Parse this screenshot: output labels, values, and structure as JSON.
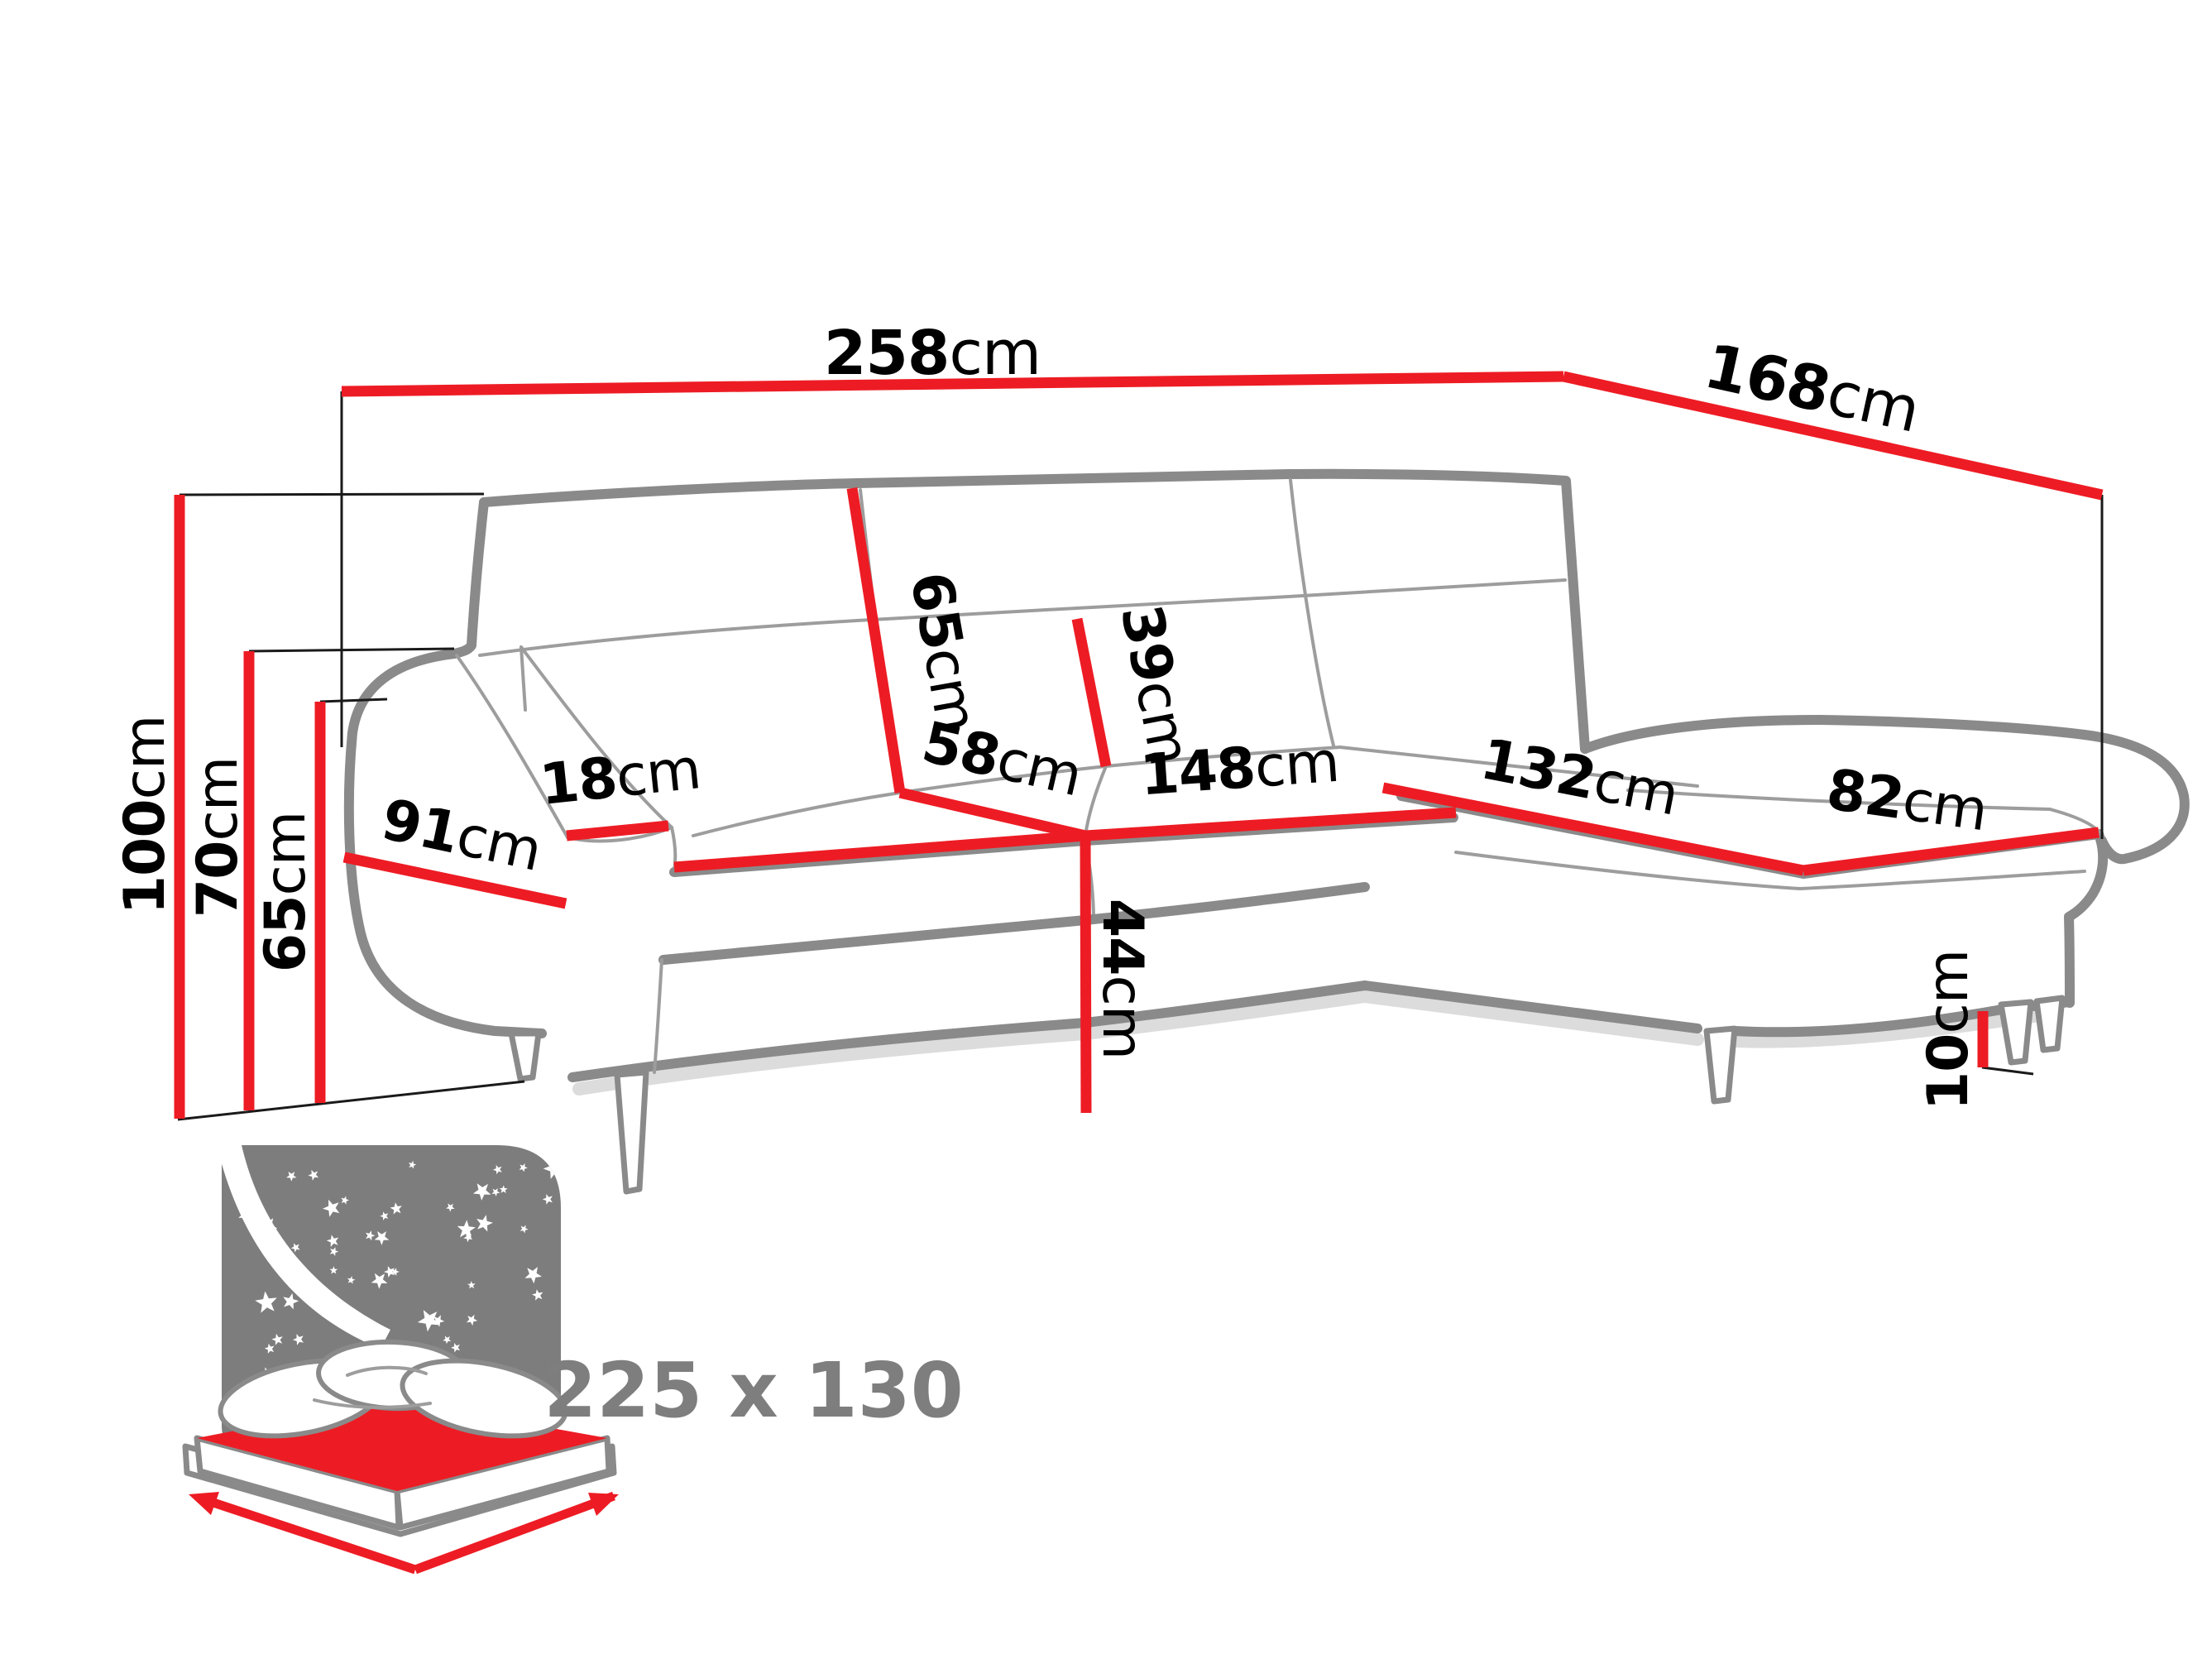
{
  "diagram": {
    "type": "corner-sofa-dimension-drawing",
    "colors": {
      "dimension_red": "#ed1c24",
      "sofa_outline_gray": "#8a8a8a",
      "label_black": "#000000",
      "icon_gray": "#7d7d7d",
      "sleeping_label_gray": "#7e7e7e"
    },
    "dims": {
      "total_width": {
        "value": "258",
        "unit": "cm"
      },
      "total_depth": {
        "value": "168",
        "unit": "cm"
      },
      "total_height": {
        "value": "100",
        "unit": "cm"
      },
      "backrest_height": {
        "value": "70",
        "unit": "cm"
      },
      "armrest_height": {
        "value": "65",
        "unit": "cm"
      },
      "backrest_width": {
        "value": "65",
        "unit": "cm"
      },
      "backrest_cushion_height": {
        "value": "39",
        "unit": "cm"
      },
      "seat_depth": {
        "value": "58",
        "unit": "cm"
      },
      "seat_width": {
        "value": "148",
        "unit": "cm"
      },
      "armrest_depth": {
        "value": "91",
        "unit": "cm"
      },
      "armrest_top_width": {
        "value": "18",
        "unit": "cm"
      },
      "chaise_length": {
        "value": "132",
        "unit": "cm"
      },
      "chaise_width": {
        "value": "82",
        "unit": "cm"
      },
      "seat_height": {
        "value": "44",
        "unit": "cm"
      },
      "leg_height": {
        "value": "10",
        "unit": "cm"
      }
    },
    "sleeping_area": {
      "size": "225 x 130"
    }
  }
}
